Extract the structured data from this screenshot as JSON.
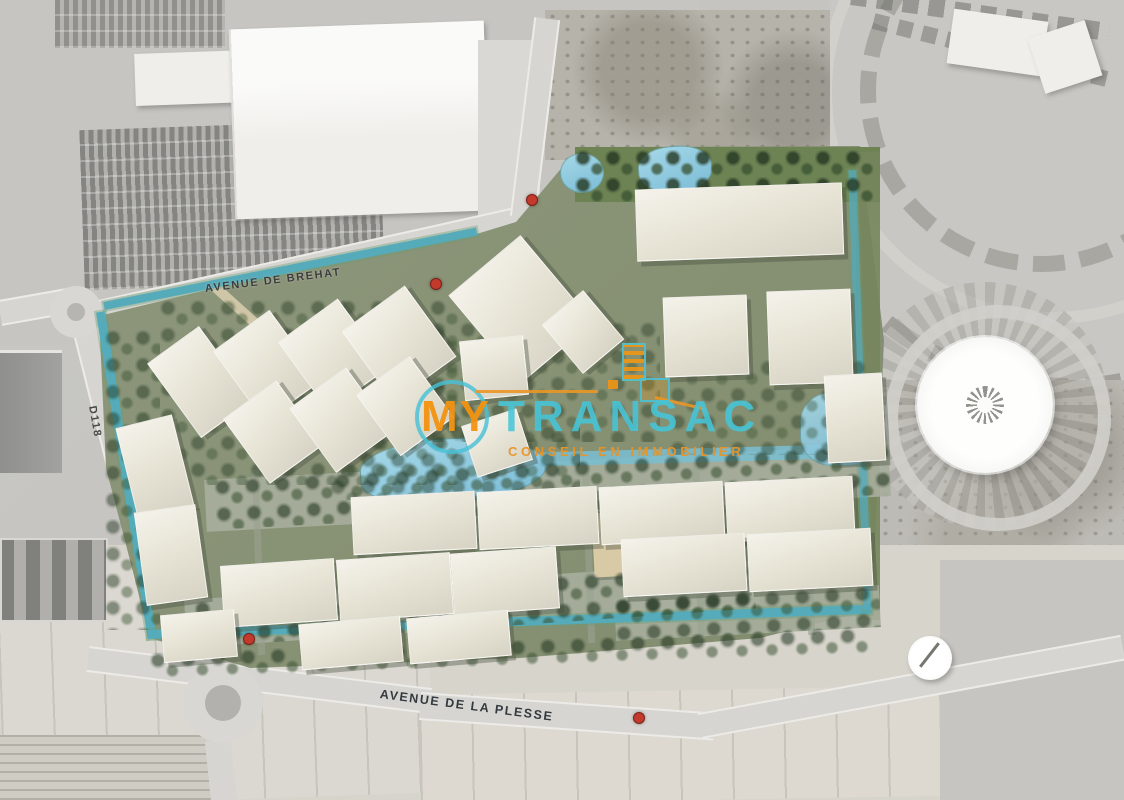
{
  "map": {
    "road_labels": [
      {
        "name": "avenue-de-brehat",
        "text": "AVENUE DE BREHAT"
      },
      {
        "name": "avenue-de-la-plesse",
        "text": "AVENUE DE LA PLESSE"
      },
      {
        "name": "d118",
        "text": "D118"
      }
    ],
    "access_marker_color": "#c23a2c",
    "palette": {
      "aerial_gray": "#c6c5c1",
      "plan_green": "#87927a",
      "tree_green": "#2e4a2d",
      "canal_teal": "#55abb9",
      "pond_blue": "#8ccadf",
      "building_beige": "#e9e6d9",
      "road_gray": "#d6d5d1",
      "field_beige": "#d9d6cf"
    }
  },
  "watermark": {
    "brand_prefix": "MY",
    "brand_suffix": "TRANSAC",
    "tagline": "CONSEIL EN IMMOBILIER",
    "colors": {
      "prefix_orange": "#f2930f",
      "suffix_teal": "#46c2d8",
      "tagline_orange": "#e8952a"
    }
  }
}
